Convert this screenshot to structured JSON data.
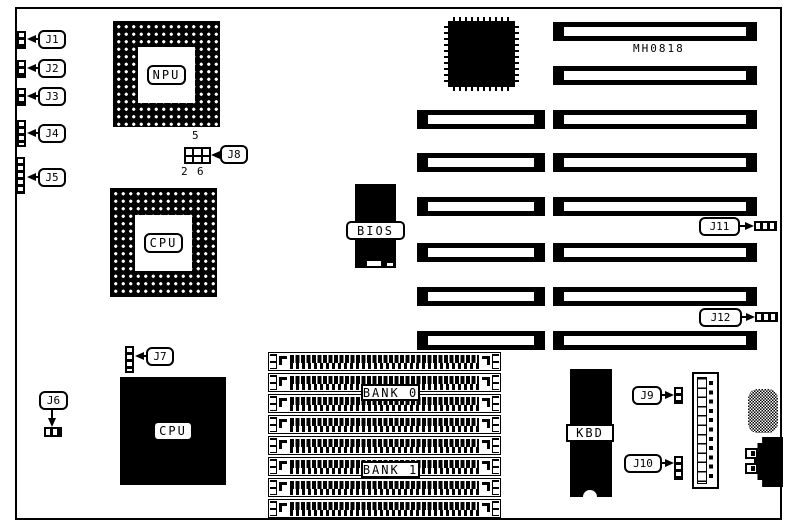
{
  "board": {
    "model": "MH0818",
    "chips": {
      "npu": "NPU",
      "cpu_socket": "CPU",
      "cpu_chip": "CPU",
      "bios": "BIOS",
      "kbd": "KBD"
    },
    "memory": {
      "bank0": "BANK 0",
      "bank1": "BANK 1",
      "simm_socket_count": 8
    },
    "connectors": {
      "j1": "J1",
      "j2": "J2",
      "j3": "J3",
      "j4": "J4",
      "j5": "J5",
      "j6": "J6",
      "j7": "J7",
      "j8": "J8",
      "j9": "J9",
      "j10": "J10",
      "j11": "J11",
      "j12": "J12"
    },
    "jumper_j8": {
      "pin5": "5",
      "pin2": "2",
      "pin6": "6"
    },
    "slots": {
      "left_column": 6,
      "right_column": 8
    },
    "colors": {
      "ink": "#000000",
      "paper": "#ffffff"
    }
  }
}
